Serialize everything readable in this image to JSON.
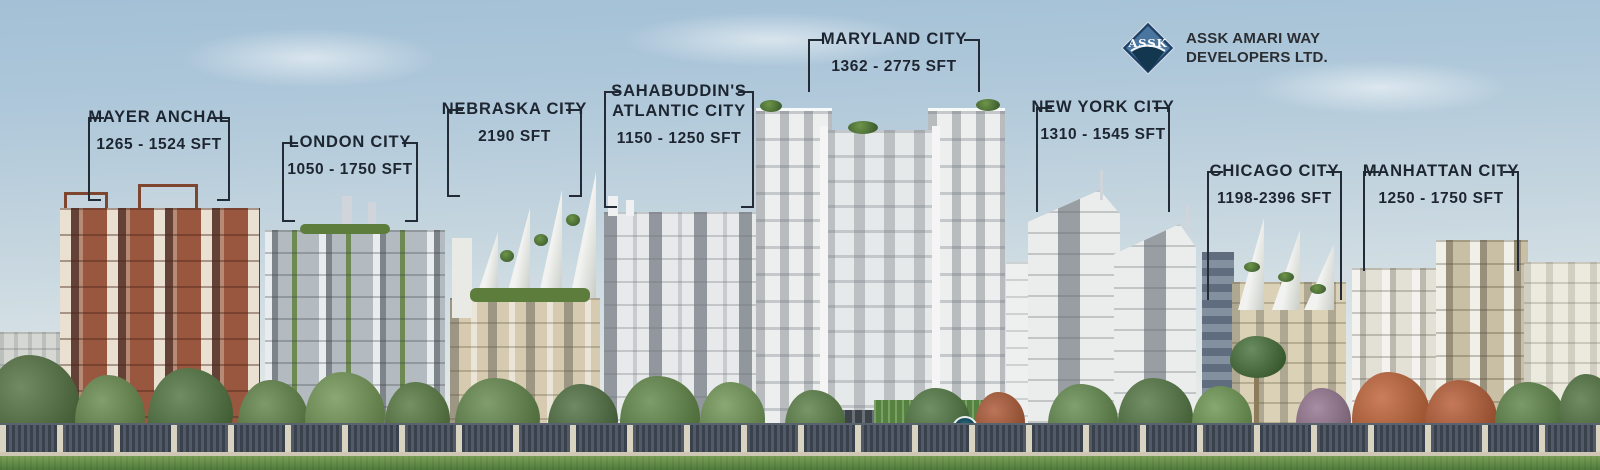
{
  "logo": {
    "mark": "ASSK",
    "line1": "ASSK AMARI WAY",
    "line2": "DEVELOPERS LTD."
  },
  "projects": [
    {
      "name": "MAYER ANCHAL",
      "sft": "1265 - 1524 SFT"
    },
    {
      "name": "LONDON CITY",
      "sft": "1050 - 1750 SFT"
    },
    {
      "name": "NEBRASKA CITY",
      "sft": "2190 SFT"
    },
    {
      "name": "SAHABUDDIN'S",
      "name2": "ATLANTIC CITY",
      "sft": "1150 - 1250 SFT"
    },
    {
      "name": "MARYLAND CITY",
      "sft": "1362 - 2775 SFT"
    },
    {
      "name": "NEW YORK CITY",
      "sft": "1310 - 1545 SFT"
    },
    {
      "name": "CHICAGO CITY",
      "sft": "1198-2396 SFT"
    },
    {
      "name": "MANHATTAN CITY",
      "sft": "1250 - 1750 SFT"
    }
  ],
  "colors": {
    "label_text": "#1d2530",
    "logo_navy": "#1e3f66",
    "sky_top": "#a3c0d6",
    "grass": "#5f8a42",
    "fence": "#38414c",
    "brick": "#99573f"
  }
}
